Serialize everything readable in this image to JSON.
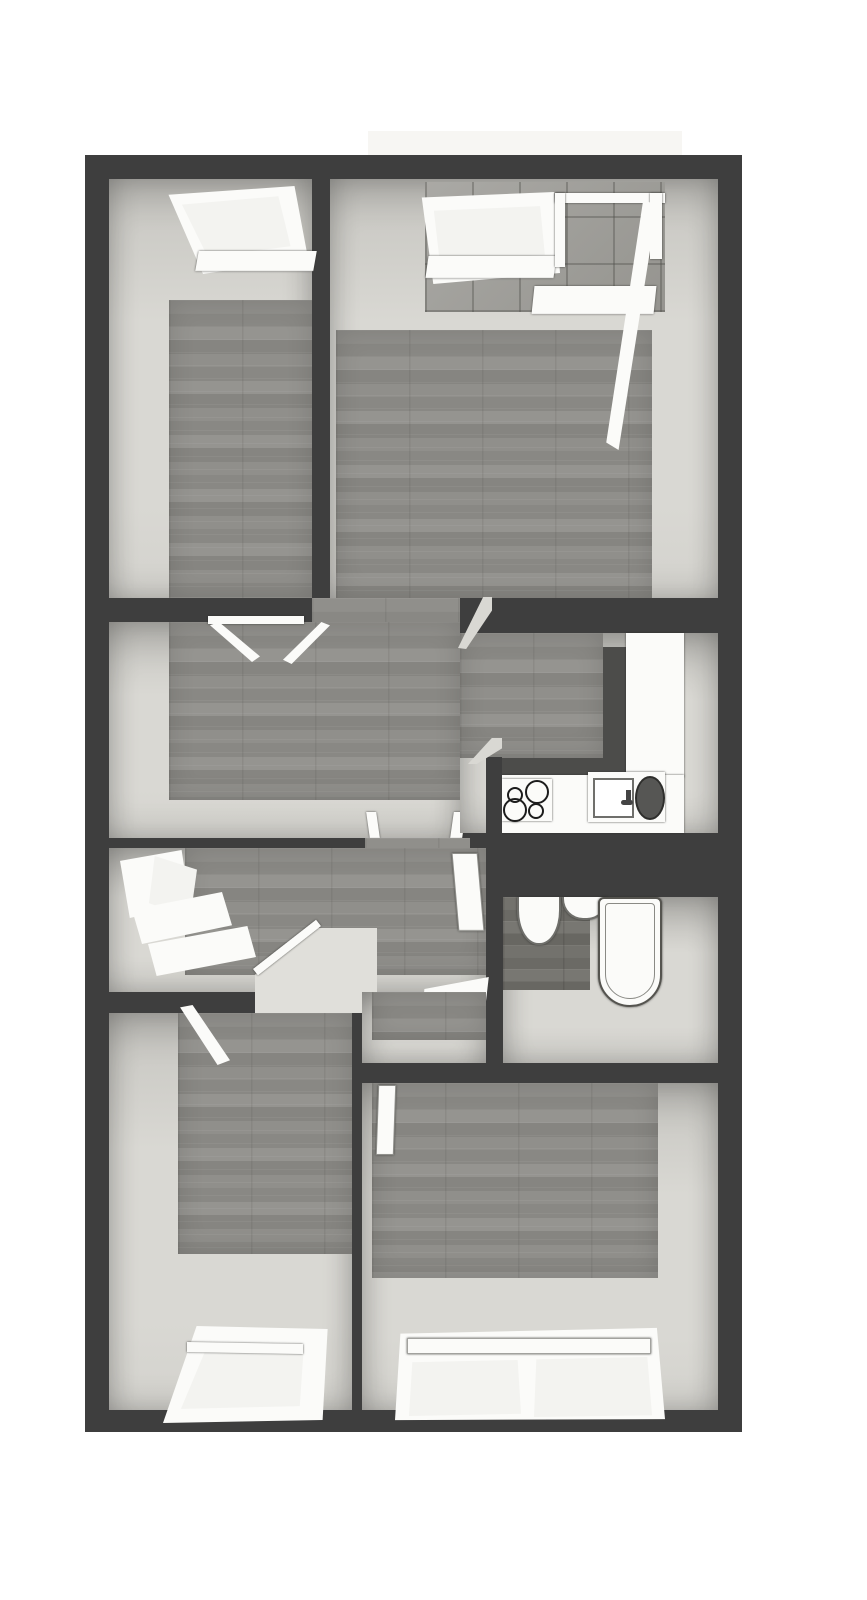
{
  "image": {
    "kind": "3d-floor-plan-render",
    "view": "top-down dollhouse view of an apartment",
    "width_px": 867,
    "height_px": 1600
  },
  "colors": {
    "background": "#ffffff",
    "wall": "#3e3e3e",
    "wallFaceLight": "#d9d8d3",
    "wallFaceShade": "#c6c5c0",
    "floorWood": "#8d8c88",
    "floorWoodDark": "#6f6e69",
    "fixtureWhite": "#fbfbf9",
    "fixtureOutline": "#6f6f6b",
    "pane": "#f3f3f0",
    "counterDark": "#4c4c4a",
    "sinkBasinDark": "#565654",
    "tile": "#a2a19d",
    "balconySlab": "#f7f6f3",
    "burnerRing": "#1c1c1c"
  },
  "plan": {
    "balcony": {
      "label": "balcony-slab",
      "location": "top edge, behind living room wall"
    },
    "rooms": [
      {
        "id": "bedroom-top-left",
        "label": "top-left room",
        "fixtures": [
          "tilt-open window (top wall)",
          "open double door to hallway"
        ]
      },
      {
        "id": "living-room",
        "label": "top-right room",
        "fixtures": [
          "window (top wall)",
          "open balcony door",
          "tiled balcony floor visible"
        ]
      },
      {
        "id": "hallway",
        "label": "central hallway",
        "fixtures": [
          "open passage to living room",
          "doorway to lower hall"
        ]
      },
      {
        "id": "kitchen",
        "label": "kitchen",
        "fixtures": [
          "L-shaped counter",
          "cooktop with 4 burner rings",
          "sink unit with dark basin"
        ]
      },
      {
        "id": "lower-hall",
        "label": "lower hall",
        "fixtures": [
          "window with sill benches (left wall)",
          "built-in closet block",
          "open door leaves"
        ]
      },
      {
        "id": "bathroom",
        "label": "bathroom",
        "fixtures": [
          "toilet",
          "round wash basin",
          "bathtub"
        ]
      },
      {
        "id": "bedroom-bottom-left",
        "label": "bottom-left room",
        "fixtures": [
          "open door",
          "window (bottom wall)"
        ]
      },
      {
        "id": "bedroom-bottom-right",
        "label": "bottom-right room",
        "fixtures": [
          "open door",
          "double window (bottom wall)"
        ]
      }
    ]
  }
}
